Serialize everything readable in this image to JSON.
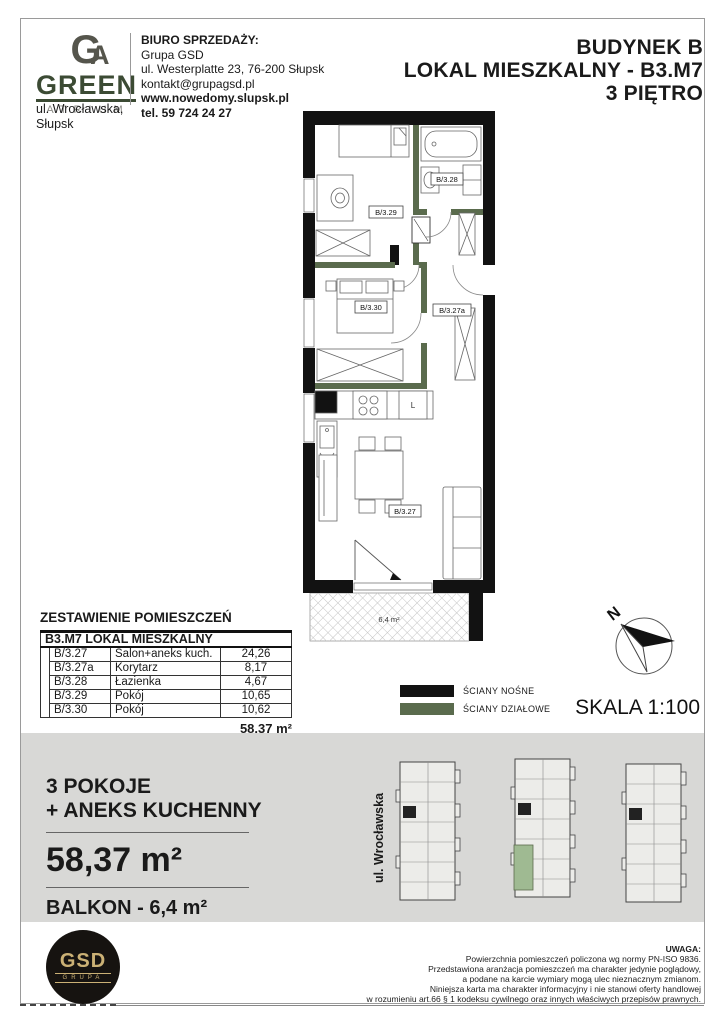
{
  "brand": {
    "monogram_g": "G",
    "monogram_a": "A",
    "name": "GREEN",
    "subname": "ATRIUM",
    "address_line1": "ul. Wrocławska,",
    "address_line2": "Słupsk"
  },
  "office": {
    "title": "BIURO SPRZEDAŻY:",
    "line1": "Grupa GSD",
    "line2": "ul. Westerplatte 23, 76-200 Słupsk",
    "line3": "kontakt@grupagsd.pl",
    "line4": "www.nowedomy.slupsk.pl",
    "line5": "tel. 59 724 24 27"
  },
  "title": {
    "line1": "BUDYNEK B",
    "line2": "LOKAL MIESZKALNY - B3.M7",
    "line3": "3 PIĘTRO"
  },
  "plan": {
    "rooms": [
      {
        "label": "B/3.29"
      },
      {
        "label": "B/3.28"
      },
      {
        "label": "B/3.30"
      },
      {
        "label": "B/3.27a"
      },
      {
        "label": "B/3.27"
      }
    ],
    "balcony_label": "6,4 m²",
    "fridge_label": "L"
  },
  "legend": {
    "load_bearing": "ŚCIANY NOŚNE",
    "partition": "ŚCIANY DZIAŁOWE",
    "load_bearing_color": "#121212",
    "partition_color": "#5a6b4d",
    "scale": "SKALA 1:100",
    "north": "N"
  },
  "table": {
    "title": "ZESTAWIENIE POMIESZCZEŃ",
    "header": "B3.M7 LOKAL MIESZKALNY",
    "rows": [
      {
        "code": "B/3.27",
        "name": "Salon+aneks kuch.",
        "area": "24,26"
      },
      {
        "code": "B/3.27a",
        "name": "Korytarz",
        "area": "8,17"
      },
      {
        "code": "B/3.28",
        "name": "Łazienka",
        "area": "4,67"
      },
      {
        "code": "B/3.29",
        "name": "Pokój",
        "area": "10,65"
      },
      {
        "code": "B/3.30",
        "name": "Pokój",
        "area": "10,62"
      }
    ],
    "total": "58,37 m²"
  },
  "summary": {
    "line1": "3 POKOJE",
    "line2": "+ ANEKS KUCHENNY",
    "area": "58,37 m²",
    "balcony": "BALKON - 6,4 m²",
    "street": "ul. Wrocławska"
  },
  "footer": {
    "logo_text": "GSD",
    "logo_subtext": "GRUPA",
    "note_title": "UWAGA:",
    "note_line1": "Powierzchnia pomieszczeń policzona wg normy PN-ISO 9836.",
    "note_line2": "Przedstawiona aranżacja pomieszczeń ma charakter jedynie poglądowy,",
    "note_line3": "a podane na karcie wymiary mogą ulec nieznacznym zmianom.",
    "note_line4": "Niniejsza karta ma charakter informacyjny i nie stanowi oferty handlowej",
    "note_line5": "w rozumieniu art.66 § 1 kodeksu cywilnego oraz innych właściwych przepisów prawnych."
  }
}
